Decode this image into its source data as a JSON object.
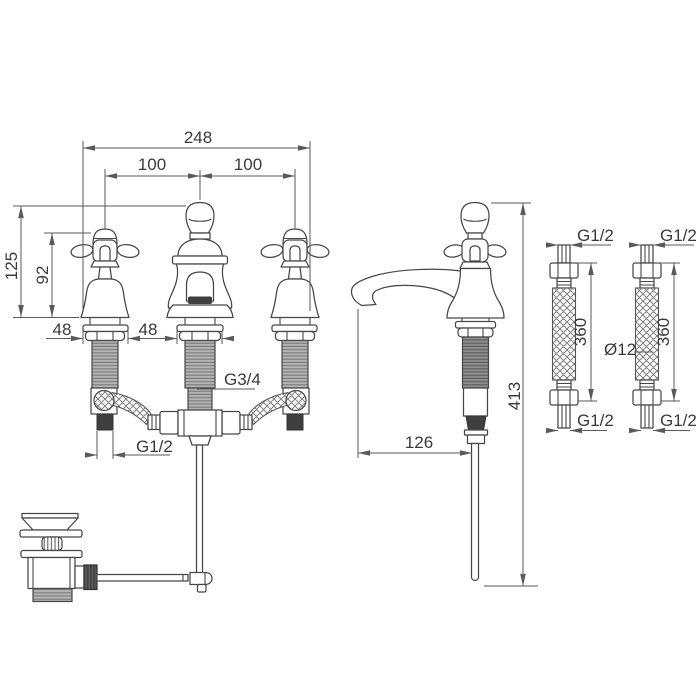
{
  "front_view": {
    "overall_width": "248",
    "center_spacing_left": "100",
    "center_spacing_right": "100",
    "height_to_handle_top": "125",
    "handle_height": "92",
    "base_width_valve": "48",
    "base_width_spout": "48",
    "spout_thread": "G3/4",
    "valve_thread": "G1/2"
  },
  "side_view": {
    "spout_projection": "126",
    "overall_height": "413"
  },
  "hoses": {
    "top_thread_left": "G1/2",
    "top_thread_right": "G1/2",
    "bottom_thread_left": "G1/2",
    "bottom_thread_right": "G1/2",
    "length_left": "360",
    "length_right": "360",
    "hose_diameter": "Ø12"
  },
  "colors": {
    "line": "#474747",
    "dimension": "#5a5a5a",
    "text": "#3a3a3a",
    "dark_fill": "#3f3f3f",
    "background": "#ffffff"
  }
}
